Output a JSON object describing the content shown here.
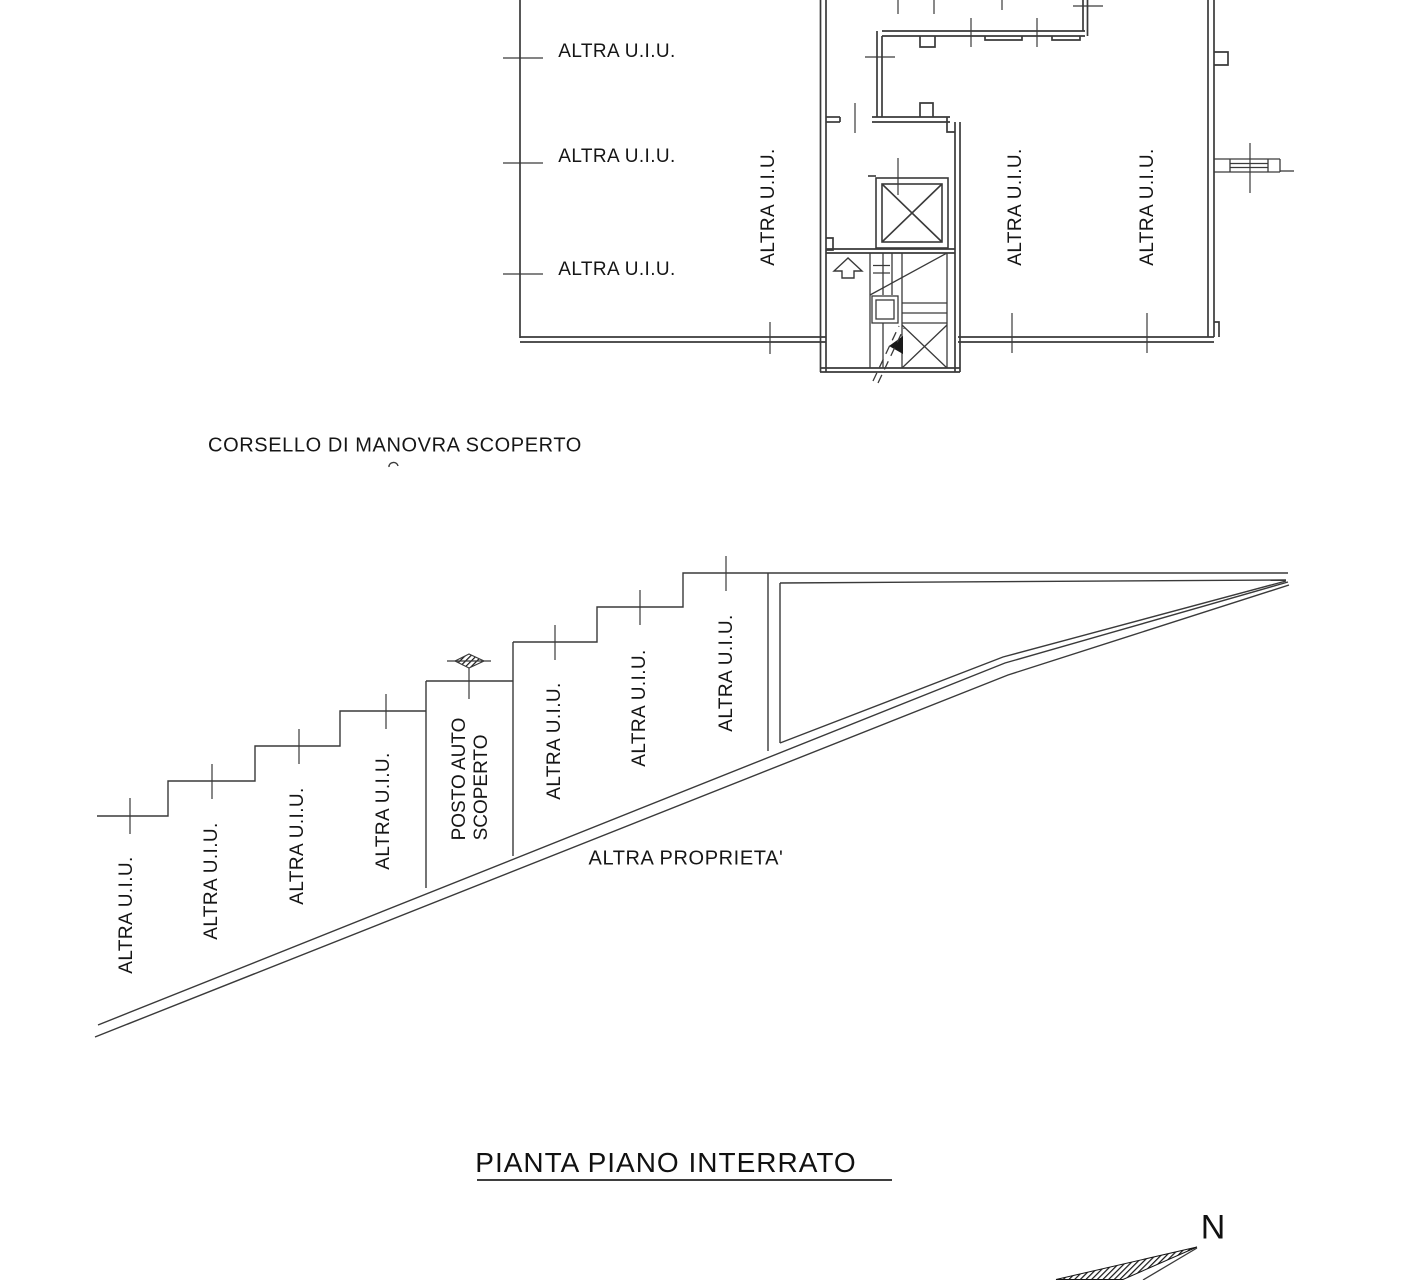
{
  "drawing": {
    "upper_plan": {
      "room_labels": [
        "ALTRA U.I.U.",
        "ALTRA U.I.U.",
        "ALTRA U.I.U."
      ],
      "adjacent_labels": [
        "ALTRA U.I.U.",
        "ALTRA U.I.U.",
        "ALTRA U.I.U."
      ]
    },
    "corridor_label": "CORSELLO DI MANOVRA SCOPERTO",
    "lower_plan": {
      "unit_labels": [
        "ALTRA U.I.U.",
        "ALTRA U.I.U.",
        "ALTRA U.I.U.",
        "ALTRA U.I.U.",
        "ALTRA U.I.U.",
        "ALTRA U.I.U.",
        "ALTRA U.I.U."
      ],
      "parking_label_line1": "POSTO AUTO",
      "parking_label_line2": "SCOPERTO",
      "boundary_label": "ALTRA PROPRIETA'"
    },
    "title": "PIANTA PIANO INTERRATO",
    "compass": {
      "north_label": "N"
    },
    "colors": {
      "line": "#3a3a3a",
      "text": "#161616"
    }
  }
}
